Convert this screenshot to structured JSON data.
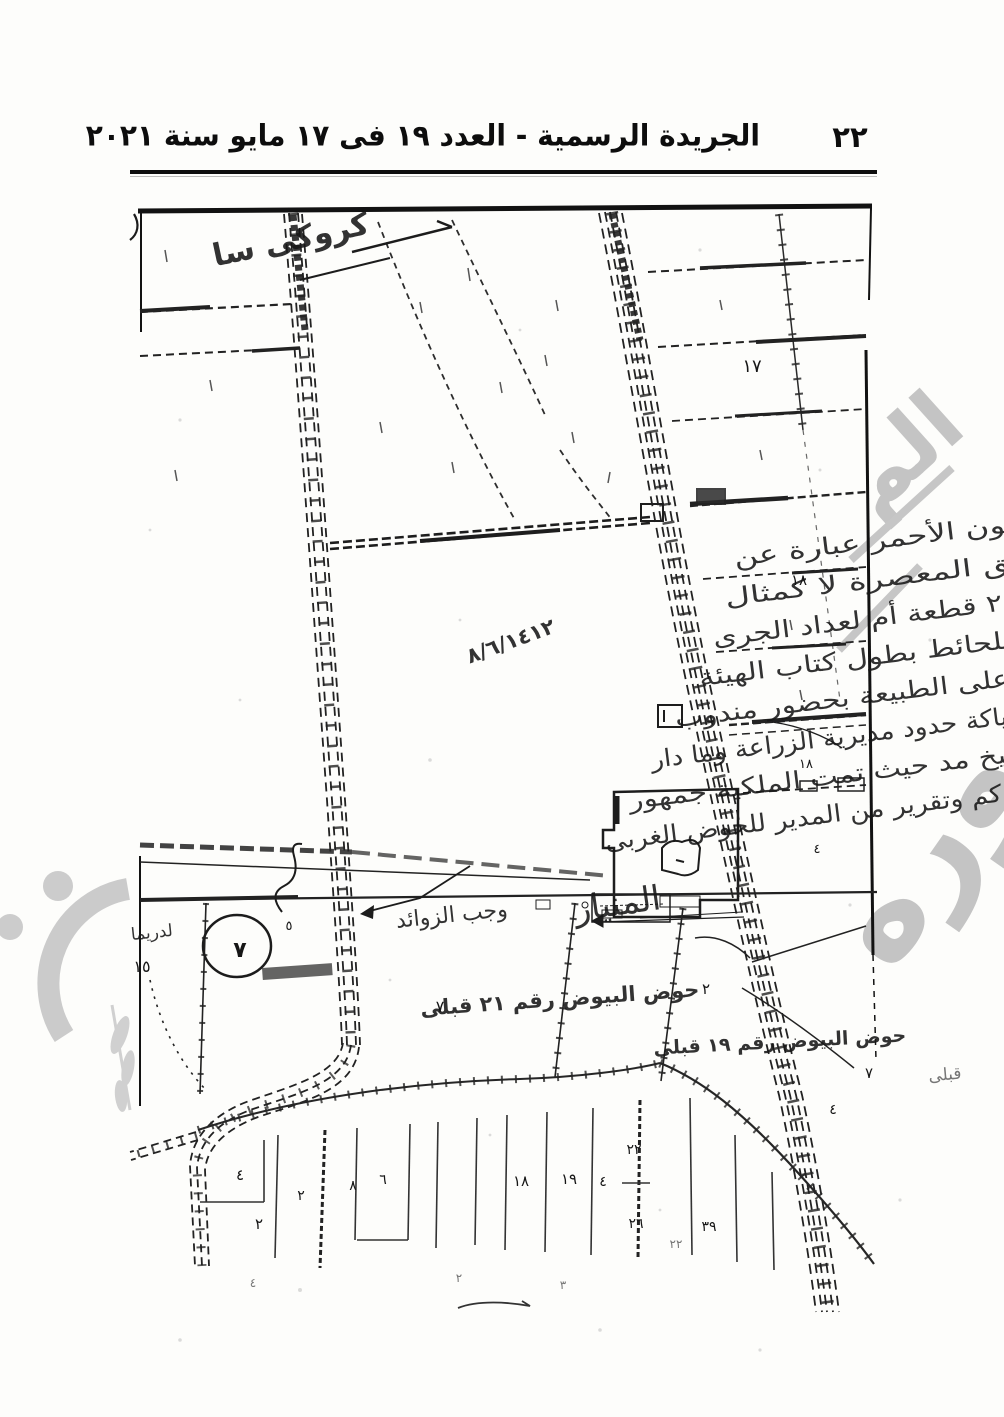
{
  "header": {
    "page_number": "٢٢",
    "title": "الجريدة الرسمية - العدد ١٩ فى ١٧ مايو سنة ٢٠٢١"
  },
  "map": {
    "sketch_note": "كروكى سا",
    "hod_label_center": "حوض البيوض رقم ٢١ قبلى",
    "hod_label_east": "حوض البيوض رقم ١٩ قبلى",
    "road_name": "المنيار",
    "side_note": "وجب الزوائد",
    "margin_note": "لدريما",
    "margin_number": "١٥",
    "corner_note": "قبلى",
    "circled_number": "٧",
    "date_note": "٨/٦/١٤١٢",
    "handwriting_lines": [
      "الرسم والمطلوب باللون الأحمر عبارة عن",
      "الواقع شرق الطريق المعصرة لا كمثال",
      "حوض البيوض رقم ٢١ قطعة أم لعداد الجرى",
      "المحيط المحاذى للحائط بطول كتاب الهيئة",
      "الصح تم الرفع على الطبيعة بحضور مندوب",
      "المهمات وشياكة حدود مديرية الزراعة وما دار",
      "بكفر شيخ مد حيث تمت الملكية جمهور",
      "أ ى كم وتقرير من المدير للحوض الغربى"
    ],
    "parcel_numbers": [
      {
        "v": "١٧"
      },
      {
        "v": "١٨"
      },
      {
        "v": "١٨"
      },
      {
        "v": "٤"
      },
      {
        "v": "٥"
      },
      {
        "v": "٧"
      },
      {
        "v": "٢"
      },
      {
        "v": "٧"
      },
      {
        "v": "٤"
      },
      {
        "v": "٤"
      },
      {
        "v": "٢"
      },
      {
        "v": "٢"
      },
      {
        "v": "٨"
      },
      {
        "v": "٦"
      },
      {
        "v": "١٨"
      },
      {
        "v": "١٩"
      },
      {
        "v": "٤"
      },
      {
        "v": "٢٢"
      },
      {
        "v": "٢٦"
      },
      {
        "v": "٣٩"
      },
      {
        "v": "٢٢"
      },
      {
        "v": "٤"
      },
      {
        "v": "٢"
      },
      {
        "v": "٣"
      }
    ]
  },
  "watermark": {
    "right_top": "الم",
    "right_main": "صوره"
  }
}
